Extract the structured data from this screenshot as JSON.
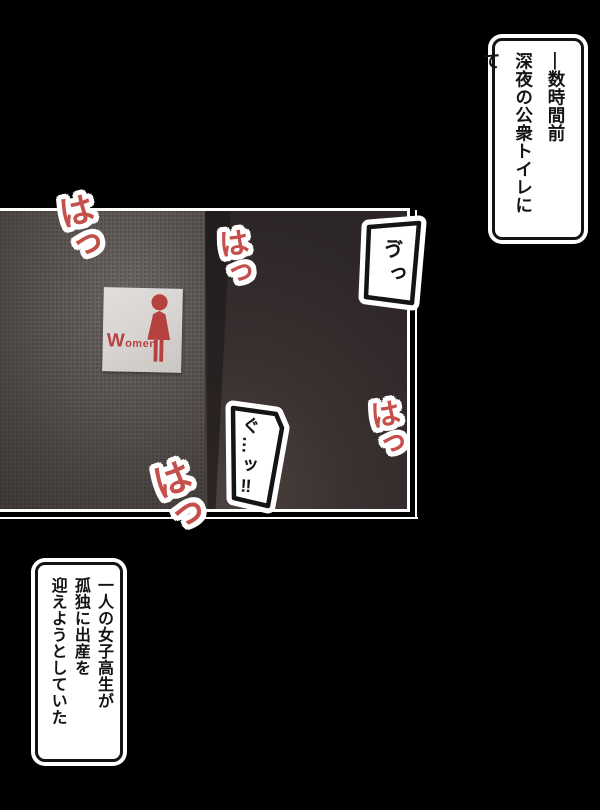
{
  "page": {
    "background": "#000000"
  },
  "narration_top": {
    "text": "―数時間前\n深夜の公衆トイレにて"
  },
  "narration_bottom": {
    "text": "一人の女子高生が\n孤独に出産を\n迎えようとしていた"
  },
  "panel": {
    "sign": {
      "label": "Women"
    },
    "bubbles": [
      {
        "text": "ゔっ"
      },
      {
        "text": "ぐ…ッ‼"
      }
    ],
    "sfx": [
      {
        "text": "はっ"
      },
      {
        "text": "はっ"
      },
      {
        "text": "はっ"
      },
      {
        "text": "はっ"
      }
    ]
  },
  "colors": {
    "sfx_red": "#c44f4b",
    "sign_red": "#b6413e",
    "sign_background": "#d8d5d2",
    "panel_border": "#ffffff",
    "narration_background": "#ffffff",
    "narration_border": "#141414"
  }
}
